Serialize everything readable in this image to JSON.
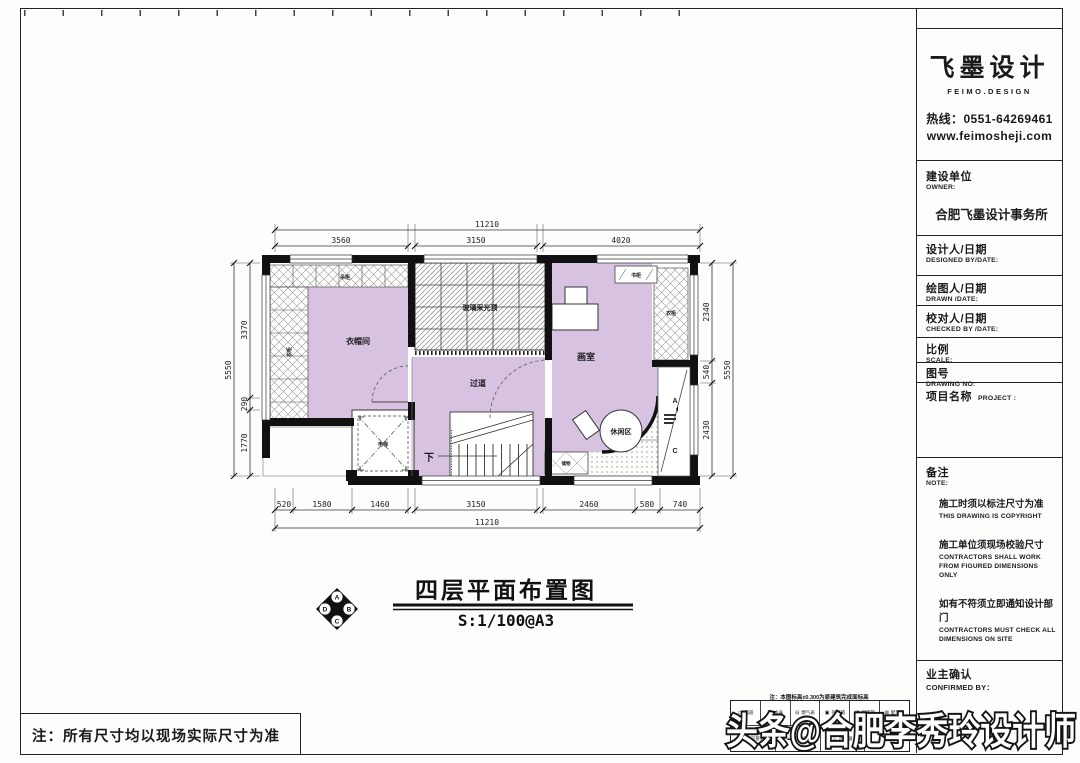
{
  "colors": {
    "room_fill": "#d7c3e1",
    "line": "#1a1a1a",
    "paper": "#fdfdfc"
  },
  "sheet": {
    "bottom_note": "注：所有尺寸均以现场实际尺寸为准",
    "elevation_note": "注：本图标高±0.300为原建筑完成面标高"
  },
  "watermark": {
    "text": "头条@合肥李秀玲设计师"
  },
  "drawing_title": {
    "name": "四层平面布置图",
    "scale": "S:1/100@A3",
    "compass": {
      "top": "A",
      "right": "B",
      "bottom": "C",
      "left": "D"
    }
  },
  "title_block": {
    "brand": {
      "name": "飞墨设计",
      "sub": "FEIMO.DESIGN",
      "hotline": "热线：0551-64269461",
      "website": "www.feimosheji.com"
    },
    "owner": {
      "cn": "建设单位",
      "en": "OWNER:",
      "value": "合肥飞墨设计事务所"
    },
    "designed": {
      "cn": "设计人/日期",
      "en": "DESIGNED BY/DATE:"
    },
    "drawn": {
      "cn": "绘图人/日期",
      "en": "DRAWN /DATE:"
    },
    "checked": {
      "cn": "校对人/日期",
      "en": "CHECKED BY /DATE:"
    },
    "scale": {
      "cn": "比例",
      "en": "SCALE:"
    },
    "drawing_no": {
      "cn": "图号",
      "en": "DRAWING NO:"
    },
    "project": {
      "cn": "项目名称",
      "en": "PROJECT :"
    },
    "note": {
      "cn": "备注",
      "en": "NOTE:",
      "items": [
        {
          "cn": "施工时须以标注尺寸为准",
          "en": "THIS DRAWING IS COPYRIGHT"
        },
        {
          "cn": "施工单位须现场校验尺寸",
          "en": "CONTRACTORS SHALL WORK FROM FIGURED DIMENSIONS ONLY"
        },
        {
          "cn": "如有不符须立即通知设计部门",
          "en": "CONTRACTORS MUST CHECK ALL DIMENSIONS ON SITE"
        }
      ]
    },
    "confirmed": {
      "cn": "业主确认",
      "en": "CONFIRMED BY："
    }
  },
  "plan": {
    "rooms": {
      "cloakroom": "衣帽间",
      "corridor": "过道",
      "studio": "画室",
      "leisure": "休闲区",
      "elevator": "电梯",
      "skylight": "玻璃采光顶",
      "stair_down": "下"
    },
    "labels": {
      "top_cabinet": "吊柜",
      "wardrobe_left": "衣柜",
      "wardrobe_right": "衣柜",
      "bookcase": "书柜",
      "storage": "储物"
    },
    "section_marks": {
      "top": "A",
      "bottom": "C"
    },
    "dims": {
      "top_total": "11210",
      "top_segs": [
        "3560",
        "3150",
        "4020"
      ],
      "bottom_segs": [
        "520",
        "1580",
        "1460",
        "3150",
        "2460",
        "580",
        "740"
      ],
      "bottom_total": "11210",
      "left_total": "5550",
      "left_segs": [
        "3370",
        "290",
        "1770"
      ],
      "right_segs": [
        "2340",
        "540",
        "2430"
      ],
      "right_total": "5550"
    }
  },
  "legend": {
    "row1": [
      {
        "icon": "▭",
        "label": "烟道"
      },
      {
        "icon": "◫",
        "label": "水表"
      },
      {
        "icon": "⊟",
        "label": "燃气表"
      },
      {
        "icon": "▣",
        "label": "强电箱"
      },
      {
        "icon": "◨",
        "label": "弱电箱"
      },
      {
        "icon": "⊠",
        "label": "配电箱"
      }
    ],
    "row2": [
      {
        "icon": "●",
        "label": "煤气管道"
      },
      {
        "icon": "▬",
        "label": "强电箱"
      },
      {
        "icon": "♨",
        "label": "热水器"
      },
      {
        "icon": "△",
        "label": "给水点"
      }
    ]
  }
}
